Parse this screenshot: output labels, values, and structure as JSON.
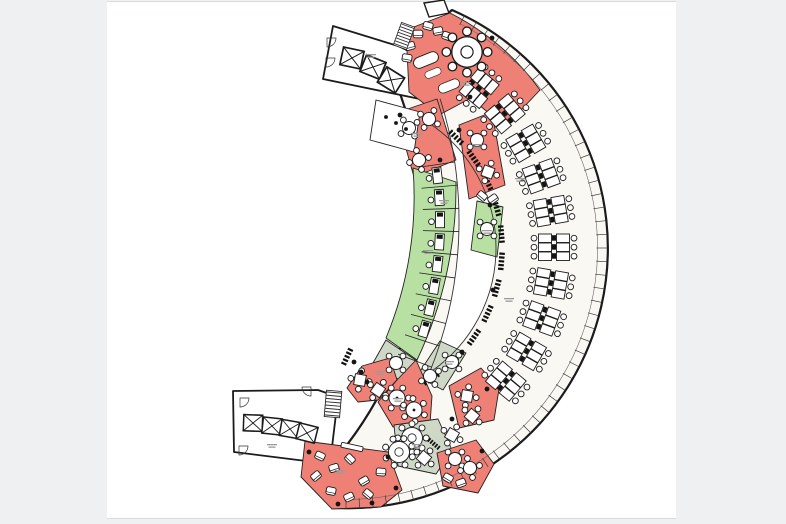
{
  "viewer": {
    "background": "#eef0f1",
    "page_background": "#ffffff",
    "page_left": 107,
    "page_top": 1,
    "page_width": 569,
    "page_height": 516
  },
  "palette": {
    "wall": "#1b1b1b",
    "band_tint": "#faf8f3",
    "red_zone": "#ef8076",
    "green_zone": "#b8e0a2",
    "sage_zone": "#cfd8c7",
    "line_gray": "#555555",
    "label_gray": "#9a9a9a"
  },
  "floor_plan": {
    "outer_center": [
      346,
      248
    ],
    "outer_radius": 260,
    "inner_center": [
      55,
      221
    ],
    "inner_radius": 368,
    "body_path": "M452,10 A260,260 0 0 1 337,508 L324,472 A368,368 0 0 0 388,65 Z",
    "corridor_path": "M432,125 A150,150 0 0 1 425.5,375.2 L429.6,372.3 A404,404 0 0 0 440.1,98.8 Z",
    "top_wing_path": "M333,26 L398,46 Q416,53 426,68 L431,80 L420,99 L323,79 Z",
    "bottom_wing_path": "M233,391 L318,390 L338,397 L330,464 L234,452 Z",
    "antenna_path": "M424,3 L444,0 L449,13 L429,17 Z",
    "zones": [
      {
        "name": "lounge-top",
        "color": "red_zone",
        "path": "M406,30 L450,13 A252,252 0 0 1 540,90 L505,127 L471,98 L439,115 L409,92 Z"
      },
      {
        "name": "tea-point-top",
        "color": "red_zone",
        "path": "M396,113 L437,99 L456,160 L414,177 Z"
      },
      {
        "name": "project-corner",
        "color": "red_zone",
        "path": "M459,125 L492,112 L505,185 L469,199 Z"
      },
      {
        "name": "office-band-green",
        "color": "green_zone",
        "path": "M413,168 L456,182 A404,404 0 0 1 417,360 L386,338 A368,368 0 0 0 413,168 Z"
      },
      {
        "name": "meeting-box-green",
        "color": "green_zone",
        "path": "M477,201 L503,207 L497,257 L471,250 Z"
      },
      {
        "name": "meeting-box-sage",
        "color": "sage_zone",
        "path": "M440,341 L466,353 L443,390 L417,376 Z"
      },
      {
        "name": "meeting-sage-low",
        "color": "sage_zone",
        "path": "M386,340 L417,361 L404,383 L373,363 Z"
      },
      {
        "name": "tea-point-low",
        "color": "red_zone",
        "path": "M347,388 L362,366 L390,358 L397,380 L378,400 L358,402 Z"
      },
      {
        "name": "cafe-mid",
        "color": "red_zone",
        "path": "M397,380 L416,360 L432,396 L430,424 L393,427 L378,402 Z"
      },
      {
        "name": "canteen-sage",
        "color": "sage_zone",
        "path": "M394,425 L438,419 L452,450 L436,474 L398,466 Z"
      },
      {
        "name": "meeting-red-right",
        "color": "red_zone",
        "path": "M449,386 L481,368 L499,389 L494,420 L459,428 Z"
      },
      {
        "name": "cafe-low-right",
        "color": "red_zone",
        "path": "M437,453 L476,440 L494,464 L478,493 L443,486 Z"
      },
      {
        "name": "lounge-bottom",
        "color": "red_zone",
        "path": "M305,441 L388,452 L402,490 L381,507 L332,509 L301,477 Z"
      },
      {
        "name": "utility-block",
        "color": "white",
        "path": "M376,100 L420,112 L414,152 L370,140 Z"
      }
    ],
    "desk_clusters": {
      "radius": 208,
      "angles": [
        -50,
        -40,
        -30,
        -20,
        -10,
        0,
        10,
        20,
        30,
        40
      ]
    },
    "cabinets": {
      "radius": 156,
      "angles": [
        -45,
        -35,
        -25,
        -15,
        -5,
        5,
        15,
        25,
        35,
        45,
        57
      ]
    },
    "offices": {
      "radius": 385,
      "t": [
        -6.8,
        -3.5,
        -0.2,
        3.1,
        6.4,
        9.7,
        13.0,
        16.3
      ]
    },
    "dividers": {
      "r1": 368,
      "r2": 404,
      "t": [
        -8.4,
        -5.1,
        -1.8,
        1.5,
        4.8,
        8.1,
        11.4,
        14.7,
        18.0,
        21.2
      ]
    },
    "corridor_edges": [
      {
        "center": "outer",
        "r": 150,
        "a0": -55,
        "a1": 58
      },
      {
        "center": "inner",
        "r": 404,
        "a0": -17.6,
        "a1": 22
      }
    ],
    "mullions": {
      "a0": -63,
      "a1": 90,
      "step": 3,
      "r_in": 250.5,
      "r_out": 261,
      "ring_r": 251.5
    },
    "furniture": [
      {
        "t": "arm",
        "x": 428,
        "y": 26,
        "r": 15
      },
      {
        "t": "arm",
        "x": 438,
        "y": 31,
        "r": -10
      },
      {
        "t": "arm",
        "x": 447,
        "y": 36,
        "r": 20
      },
      {
        "t": "arm",
        "x": 418,
        "y": 34,
        "r": 0
      },
      {
        "t": "arm",
        "x": 410,
        "y": 46,
        "r": -15
      },
      {
        "t": "arm",
        "x": 407,
        "y": 58,
        "r": 10
      },
      {
        "t": "oval",
        "x": 426,
        "y": 60,
        "r": -22
      },
      {
        "t": "oval",
        "x": 449,
        "y": 86,
        "r": -22,
        "s": 0.85
      },
      {
        "t": "oval",
        "x": 433,
        "y": 73,
        "r": -22,
        "s": 0.65
      },
      {
        "t": "round8",
        "x": 467,
        "y": 52,
        "r": 0,
        "s": 1.45
      },
      {
        "t": "blob",
        "x": 470,
        "y": 97
      },
      {
        "t": "blob",
        "x": 410,
        "y": 30
      },
      {
        "t": "blob",
        "x": 492,
        "y": 38
      },
      {
        "t": "round4",
        "x": 409,
        "y": 128,
        "r": 10
      },
      {
        "t": "round4",
        "x": 429,
        "y": 119,
        "r": -15
      },
      {
        "t": "round4",
        "x": 419,
        "y": 160,
        "r": 30
      },
      {
        "t": "blob",
        "x": 440,
        "y": 160
      },
      {
        "t": "blob",
        "x": 400,
        "y": 115
      },
      {
        "t": "round4",
        "x": 477,
        "y": 140,
        "r": 0
      },
      {
        "t": "sq4",
        "x": 488,
        "y": 172,
        "r": 20
      },
      {
        "t": "round4",
        "x": 487,
        "y": 229,
        "r": 0
      },
      {
        "t": "arm",
        "x": 482,
        "y": 196,
        "r": 40
      },
      {
        "t": "arm",
        "x": 493,
        "y": 199,
        "r": -35
      },
      {
        "t": "round4",
        "x": 452,
        "y": 362,
        "r": 0
      },
      {
        "t": "round4",
        "x": 430,
        "y": 376,
        "r": 15
      },
      {
        "t": "round4",
        "x": 396,
        "y": 363,
        "r": 0
      },
      {
        "t": "sq4",
        "x": 360,
        "y": 380,
        "r": 10
      },
      {
        "t": "sq4",
        "x": 378,
        "y": 390,
        "r": 35
      },
      {
        "t": "round6",
        "x": 397,
        "y": 398,
        "r": 0
      },
      {
        "t": "round6",
        "x": 414,
        "y": 410,
        "r": 25
      },
      {
        "t": "round8",
        "x": 412,
        "y": 438,
        "r": 0
      },
      {
        "t": "round8",
        "x": 399,
        "y": 452,
        "r": 20
      },
      {
        "t": "sq4",
        "x": 424,
        "y": 458,
        "r": 40
      },
      {
        "t": "comb",
        "x": 434,
        "y": 444,
        "r": 40,
        "s": 0.8
      },
      {
        "t": "sq4",
        "x": 467,
        "y": 396,
        "r": 10
      },
      {
        "t": "sq4",
        "x": 472,
        "y": 416,
        "r": 40
      },
      {
        "t": "blob",
        "x": 487,
        "y": 389
      },
      {
        "t": "blob",
        "x": 452,
        "y": 419
      },
      {
        "t": "round4",
        "x": 455,
        "y": 459,
        "r": 0
      },
      {
        "t": "round4",
        "x": 470,
        "y": 468,
        "r": 30
      },
      {
        "t": "arm",
        "x": 448,
        "y": 478,
        "r": 30
      },
      {
        "t": "arm",
        "x": 461,
        "y": 483,
        "r": -20
      },
      {
        "t": "blob",
        "x": 482,
        "y": 451
      },
      {
        "t": "bar",
        "x": 352,
        "y": 447,
        "r": 12
      },
      {
        "t": "arm",
        "x": 320,
        "y": 456,
        "r": 25
      },
      {
        "t": "arm",
        "x": 334,
        "y": 468,
        "r": -18
      },
      {
        "t": "arm",
        "x": 350,
        "y": 459,
        "r": 45
      },
      {
        "t": "arm",
        "x": 364,
        "y": 481,
        "r": -30
      },
      {
        "t": "arm",
        "x": 331,
        "y": 491,
        "r": 12
      },
      {
        "t": "arm",
        "x": 349,
        "y": 497,
        "r": -25
      },
      {
        "t": "arm",
        "x": 368,
        "y": 494,
        "r": 40
      },
      {
        "t": "arm",
        "x": 381,
        "y": 472,
        "r": 5
      },
      {
        "t": "arm",
        "x": 316,
        "y": 476,
        "r": -40
      },
      {
        "t": "blob",
        "x": 309,
        "y": 452
      },
      {
        "t": "blob",
        "x": 388,
        "y": 457
      },
      {
        "t": "blob",
        "x": 396,
        "y": 488
      },
      {
        "t": "blob",
        "x": 372,
        "y": 503
      },
      {
        "t": "blob",
        "x": 338,
        "y": 504
      },
      {
        "t": "comb",
        "x": 347,
        "y": 357,
        "r": 115
      },
      {
        "t": "stairs",
        "x": 333,
        "y": 404,
        "r": 95,
        "s": 1.1
      },
      {
        "t": "blob",
        "x": 354,
        "y": 362
      },
      {
        "t": "blob",
        "x": 361,
        "y": 372
      },
      {
        "t": "blob",
        "x": 367,
        "y": 382
      },
      {
        "t": "blob",
        "x": 386,
        "y": 117,
        "s": 0.8
      },
      {
        "t": "blob",
        "x": 396,
        "y": 123,
        "s": 0.8
      },
      {
        "t": "blob",
        "x": 406,
        "y": 129,
        "s": 0.8
      },
      {
        "t": "stairs",
        "x": 404,
        "y": 36,
        "r": 110
      },
      {
        "t": "elev",
        "x": 352,
        "y": 58,
        "r": 12
      },
      {
        "t": "elev",
        "x": 373,
        "y": 67,
        "r": 22
      },
      {
        "t": "elev",
        "x": 391,
        "y": 80,
        "r": 32
      },
      {
        "t": "elev",
        "x": 253,
        "y": 423,
        "r": 2,
        "s": 0.9
      },
      {
        "t": "elev",
        "x": 272,
        "y": 426,
        "r": 6,
        "s": 0.9
      },
      {
        "t": "elev",
        "x": 290,
        "y": 429,
        "r": 10,
        "s": 0.9
      },
      {
        "t": "elev",
        "x": 307,
        "y": 433,
        "r": 14,
        "s": 0.9
      },
      {
        "t": "door",
        "x": 327,
        "y": 38,
        "r": 180
      },
      {
        "t": "door",
        "x": 326,
        "y": 58,
        "r": 180
      },
      {
        "t": "door",
        "x": 240,
        "y": 398,
        "r": 180
      },
      {
        "t": "door",
        "x": 239,
        "y": 446,
        "r": 180
      },
      {
        "t": "door",
        "x": 311,
        "y": 387,
        "r": 270
      },
      {
        "t": "sq4",
        "x": 452,
        "y": 435,
        "r": 30
      },
      {
        "t": "blob",
        "x": 459,
        "y": 130
      },
      {
        "t": "blob",
        "x": 490,
        "y": 205
      },
      {
        "t": "blob",
        "x": 493,
        "y": 290
      },
      {
        "t": "blob",
        "x": 462,
        "y": 352
      },
      {
        "t": "label",
        "x": 371,
        "y": 56
      },
      {
        "t": "label",
        "x": 272,
        "y": 446
      },
      {
        "t": "label",
        "x": 477,
        "y": 146
      },
      {
        "t": "label",
        "x": 487,
        "y": 232
      },
      {
        "t": "label",
        "x": 417,
        "y": 135
      },
      {
        "t": "label",
        "x": 449,
        "y": 363
      },
      {
        "t": "label",
        "x": 398,
        "y": 400
      },
      {
        "t": "label",
        "x": 417,
        "y": 446
      },
      {
        "t": "label",
        "x": 340,
        "y": 472
      },
      {
        "t": "label",
        "x": 466,
        "y": 84
      },
      {
        "t": "label",
        "x": 509,
        "y": 300
      },
      {
        "t": "label",
        "x": 520,
        "y": 180
      },
      {
        "t": "label",
        "x": 444,
        "y": 202
      },
      {
        "t": "label",
        "x": 428,
        "y": 252
      },
      {
        "t": "label",
        "x": 380,
        "y": 373
      }
    ]
  }
}
